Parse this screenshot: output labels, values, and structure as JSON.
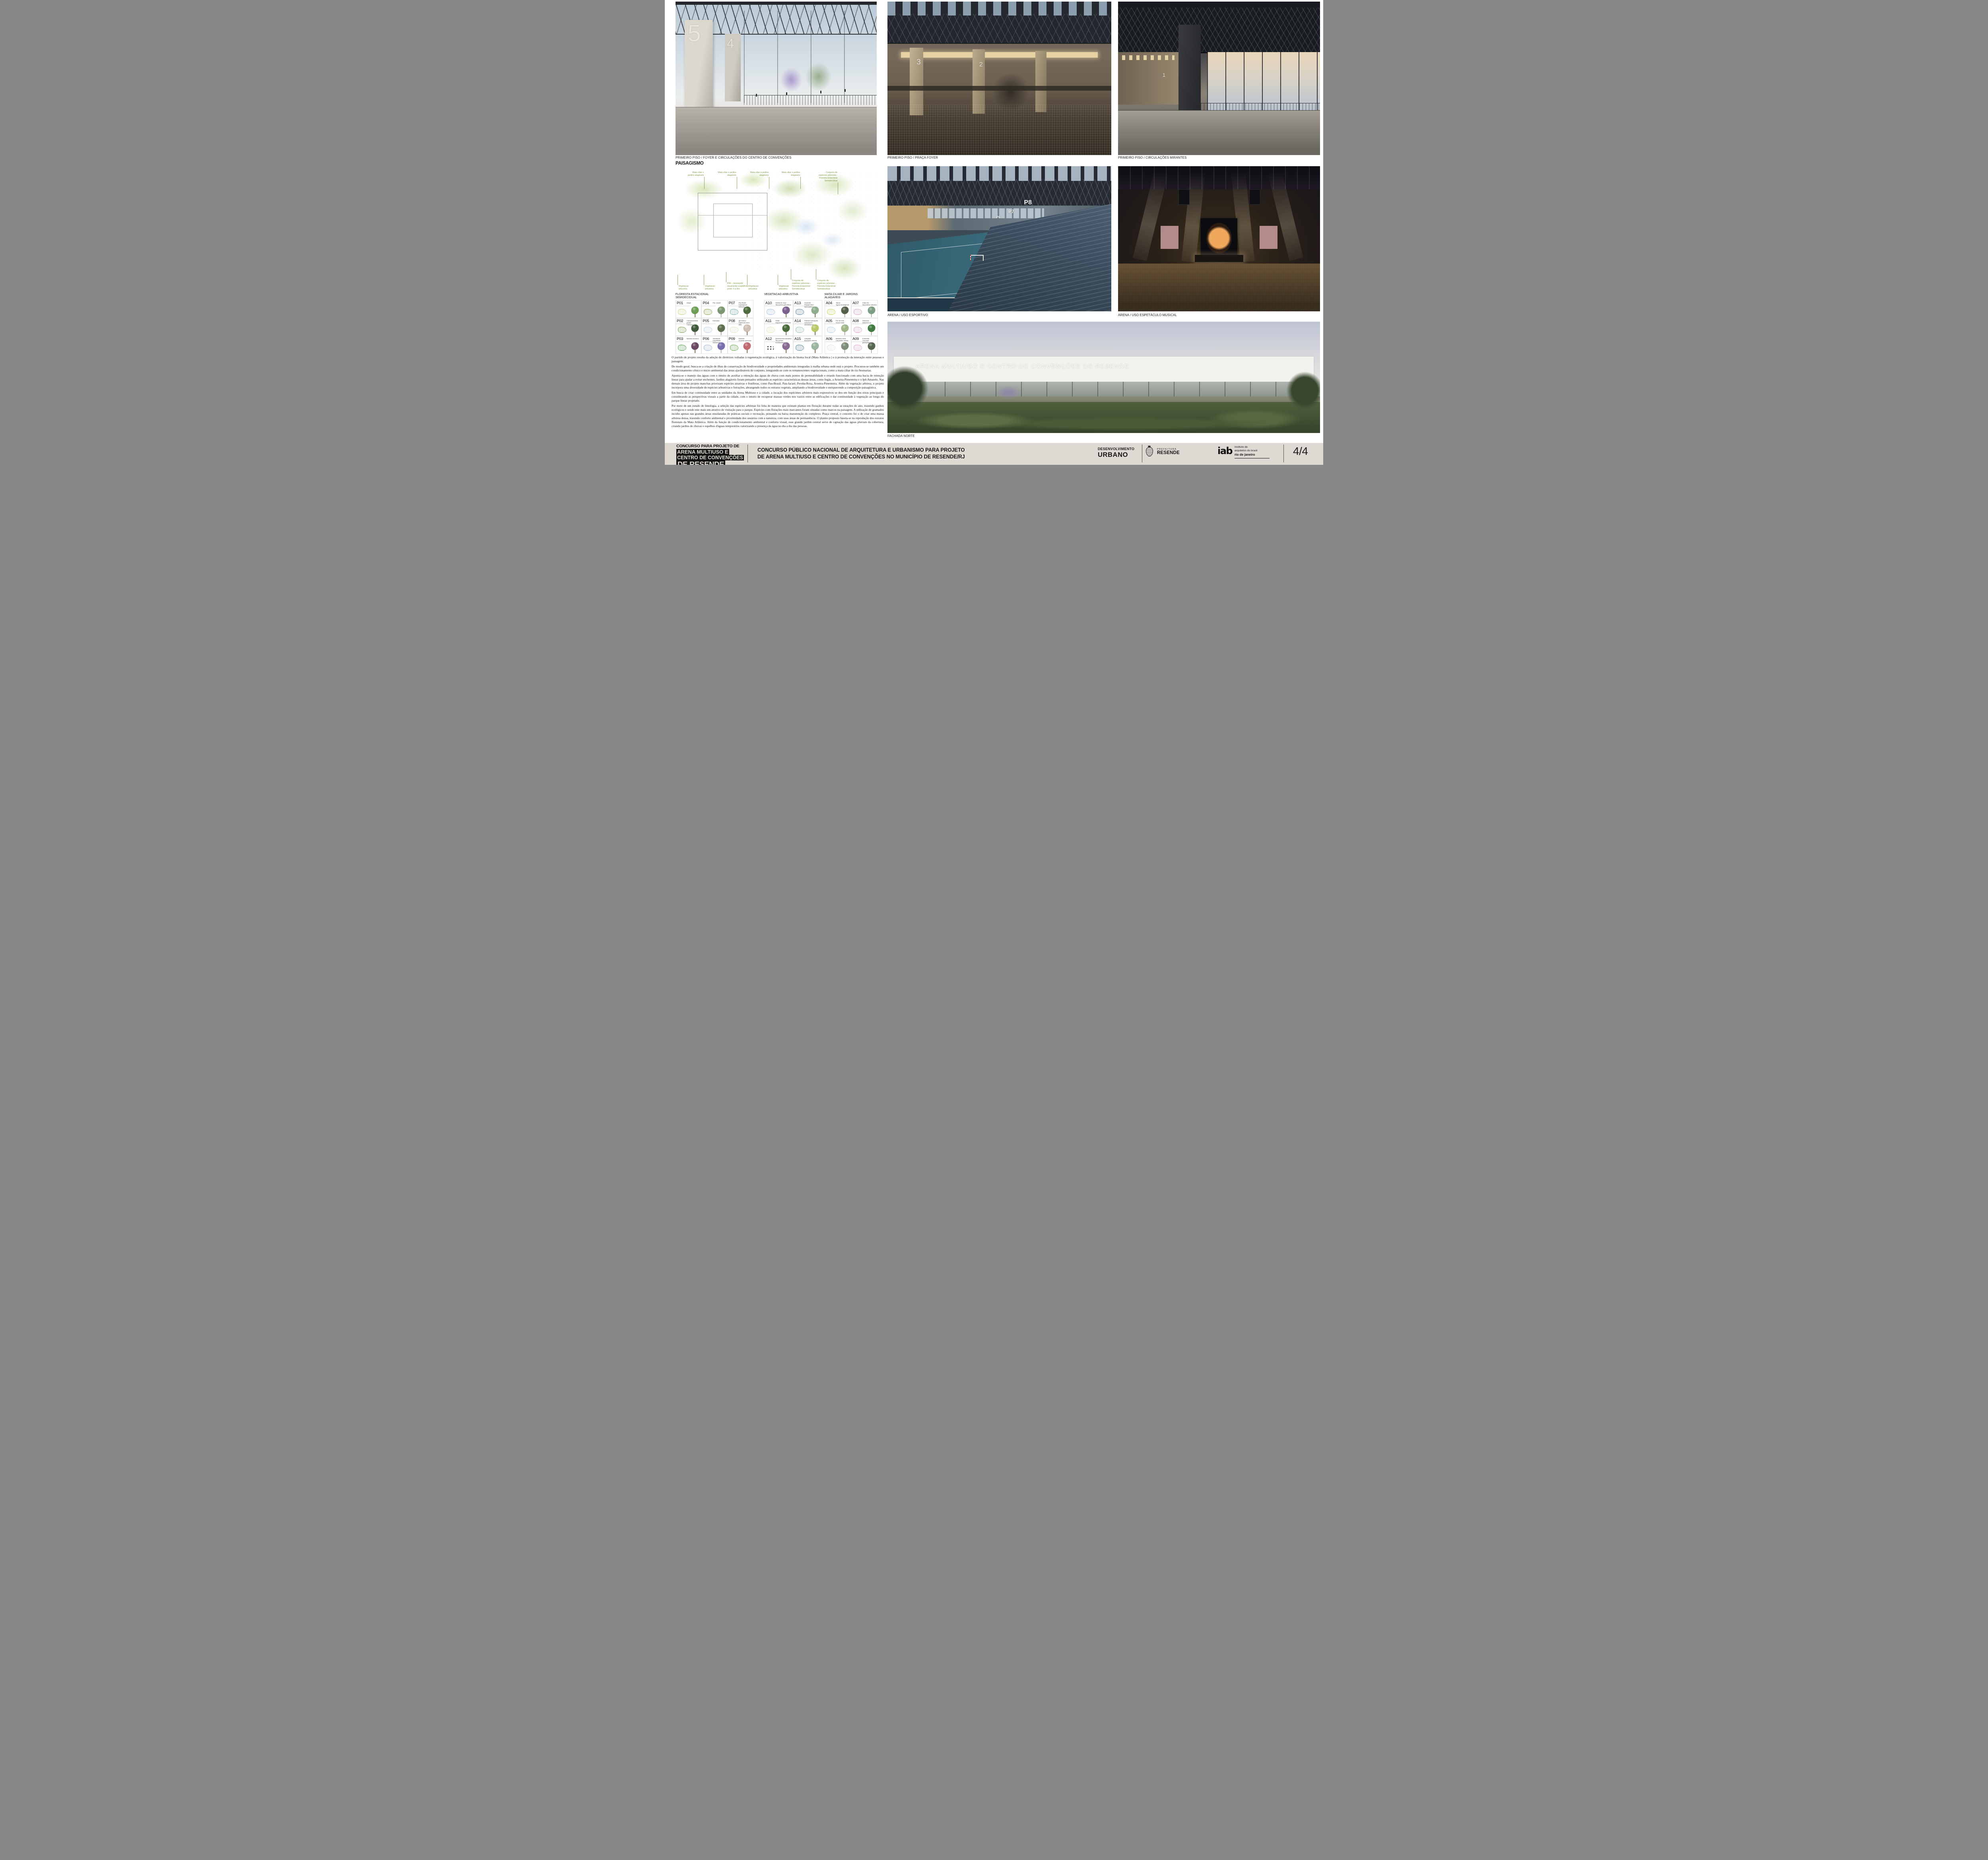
{
  "board": {
    "section_heading": "PAISAGISMO"
  },
  "colors": {
    "page_bg": "#ffffff",
    "footer_bg": "#dedad3",
    "plan_label_green": "#7c9a45",
    "footer_ink": "#131313"
  },
  "captions": {
    "render1": "PRIMEIRO PISO / FOYER E CIRCULAÇÕES DO CENTRO DE CONVENÇÕES",
    "render2": "PRIMEIRO PISO / PRAÇA FOYER",
    "render3": "PRIMEIRO PISO / CIRCULAÇÕES MIRANTES",
    "render4": "ARENA / USO ESPORTIVO",
    "render5": "ARENA / USO ESPETÁCULO MUSICAL",
    "render6": "FACHADA NORTE"
  },
  "render_overlays": {
    "render1_numbers": [
      "5",
      "4"
    ],
    "render2_numbers": [
      "3",
      "2"
    ],
    "render3_numbers": [
      "1"
    ],
    "arena_signs": [
      "P8",
      "P7",
      "P6"
    ],
    "fachada_building_title": "ARENA MULTIUSO E CENTRO DE CONVENÇÕES DE RESENDE"
  },
  "plan": {
    "labels_top": [
      "Mata ciliar e\njardins alagáveis",
      "Mata ciliar e jardins\nalagáveis",
      "Mata ciliar e jardins\nalagáveis",
      "Mata ciliar e jardins\nalagáveis",
      "Conjunto de\nespécies arboreas -\nFloresta Estacional\nSemidecidual"
    ],
    "labels_bottom": [
      "Vegetacao\narbustiva",
      "Vegetacao\narbustiva",
      "P06 - Jacarandá\nJacaranda cuspidifolia\nporte: 5 a 8m",
      "Vegetacao\narbustiva",
      "Vegetacao\narbustiva",
      "Conjunto de\nespécies arboreas -\nFloresta Estacional\nSemidecidual",
      "Conjunto de\nespécies arboreas -\nFloresta Estacional\nSemidecidual"
    ]
  },
  "legend": {
    "groups": [
      {
        "title": "FLORESTA ESTACIONAL\nSEMIDECIDUAL",
        "items": [
          {
            "code": "P01",
            "name": "Araçá",
            "swatch": "#c9da8a",
            "photo": "#6f9e56"
          },
          {
            "code": "P02",
            "name": "Campomanesia phaea\nCambuci",
            "swatch": "#7aa84e",
            "photo": "#3f5a3a"
          },
          {
            "code": "P03",
            "name": "Manacá da serra",
            "swatch": "#57a84e",
            "photo": "#6b4a63"
          },
          {
            "code": "P04",
            "name": "Pau Jacaré",
            "swatch": "#8fae56",
            "photo": "#7d9770"
          },
          {
            "code": "P05",
            "name": "Embauba",
            "swatch": "#bcd3ea",
            "photo": "#5e7050"
          },
          {
            "code": "P06",
            "name": "Jacaranda cuspidifolia\nJacarandá",
            "swatch": "#9db8d8",
            "photo": "#7a6fae"
          },
          {
            "code": "P07",
            "name": "Pau Brasil\nCaesalpinia echinata",
            "swatch": "#7fb2b2",
            "photo": "#4e6b3c"
          },
          {
            "code": "P08",
            "name": "Ipê branco\nTabebuia roseo-alba",
            "swatch": "#d8e6c2",
            "photo": "#cfc0b4"
          },
          {
            "code": "P09",
            "name": "Paineira\nChorisia speciosa",
            "swatch": "#6cae52",
            "photo": "#c06a72"
          }
        ]
      },
      {
        "title": "VEGETACAO ARBUSTIVA",
        "items": [
          {
            "code": "A10",
            "name": "Orelha de onça\nTibouchina grandiflora",
            "swatch": "#a9c4e0",
            "photo": "#7b5f8f"
          },
          {
            "code": "A11",
            "name": "Triális\nGalphimia brasiliensis",
            "swatch": "#dfe8bb",
            "photo": "#4a6b3a"
          },
          {
            "code": "A12",
            "name": "Quaresmeira arbustiva\nTibouchina moricandiana",
            "swatch": "#333333",
            "photo": "#8a6b93"
          },
          {
            "code": "A13",
            "name": "Guaimbé\nPhilodendron bipinnatifidum",
            "swatch": "#6f8fa5",
            "photo": "#8fae8f"
          },
          {
            "code": "A14",
            "name": "Palmeira petrópolis\nLytocaryum weddellianum",
            "swatch": "#9fc4bd",
            "photo": "#b9c96a"
          },
          {
            "code": "A15",
            "name": "Carqueja\nBaccharis trimera",
            "swatch": "#5f8fa0",
            "photo": "#9ab5a0"
          }
        ]
      },
      {
        "title": "MATA CILIAR E JARDINS\nALAGAVEIS",
        "items": [
          {
            "code": "A04",
            "name": "Taboa\nTypha domingensii",
            "swatch": "#cada6a",
            "photo": "#55604a"
          },
          {
            "code": "A05",
            "name": "Flor de vela\nSenna alata",
            "swatch": "#b9d0e6",
            "photo": "#9fb789"
          },
          {
            "code": "A06",
            "name": "Maranta cinza\nCtenanthe setosa",
            "swatch": "#dfe8e2",
            "photo": "#7f8f77"
          },
          {
            "code": "A07",
            "name": "Falsa íris\nNeomarica caerulea",
            "swatch": "#d8a9c9",
            "photo": "#7d9f86"
          },
          {
            "code": "A08",
            "name": "Heliconia\nHeliconia sp",
            "swatch": "#e0a9cf",
            "photo": "#3f7a3f"
          },
          {
            "code": "A09",
            "name": "Embauba\nCecropia pachystachya",
            "swatch": "#e3a9d0",
            "photo": "#55684f"
          }
        ]
      }
    ]
  },
  "text_block": {
    "paragraphs": [
      "O partido de projeto resulta da adoção de diretrizes voltadas à regeneração ecológica, à valorização do bioma local (Mata Atlântica ) e à promoção da interação entre pessoas e paisagem.",
      "De modo geral, busca-se a criação de ilhas de conservação de biodiversidade e propriedades ambientais integradas à malha urbana onde está o projeto. Procurou-se também um condicionamento cênico e micro ambiental das áreas ajardináveis do conjunto, integrando-se com os remanescentes vegetacionais, como a mata ciliar do rio Sesmarias.",
      "Aponta-se o manejo das águas com o intuito de auxiliar a retenção das águas de chuva com mais pontos de permeabilidade e retardo funcionado com uma bacia de retenção linear para ajudar a evitar enchentes. Jardins alagáveis foram pensados utilizando as espécies características dessas áreas, como Ingás, a Aroeira-Pimenteira e o Ipê-Amarelo. Nas demais área do projeto manchas priorizam espécies atrativas e frutíferas, como Pau-Brasil, Pau-Jacaré, Peroba-Rosa, Aroeira-Pimenteira. Além da vegetação arbórea, o projeto incorpora uma diversidade de espécies arbustivas e forrações, abrangendo todos os estratos vegetais, ampliando a biodiversidade e enriquecendo a composição paisagística.",
      "Em busca de criar continuidade entre as unidades da Arena Multiuso e a cidade, a locação dos espécimes arbóreos mais expressivos se deu em função dos eixos principais e considerando as perspectivas visuais a partir da cidade, com o intuito de recuperar massas verdes nos vazios entre as edificações e dar continuidade à vegetação ao longo do parque linear projetado.",
      "Por meio de um estudo de fenologia, a seleção das espécies arbóreas foi feita de maneira que existam plantas em floração durante todas as estações do ano, trazendo ganhos ecológicos e sendo este mais um atrativo de visitação para o parque. Espécies com florações mais marcantes foram situadas como marcos na paisagem. A utilização de gramados incidiu apenas nas grandes áreas ensolaradas de práticas sociais e recreação, pensando na baixa manutenção do complexo. Praça central, o conceito foi o de criar uma massa arbórea densa, trazendo conforto ambiental e proximidade dos usuários com a natureza, com suas áreas de permanência. O plantio proposto baseia-se na reprodução dos estratos florestais da Mata Atlântica. Além da função de condicionamento ambiental e conforto visual, esse grande jardim central serve de captação das águas pluviais da cobertura, criando jardins de chuvas e espelhos d'águas temporários valorizando a presença da água no dia a dia das pessoas."
    ]
  },
  "footer": {
    "box_line1": "CONCURSO PARA PROJETO DE",
    "box_line2": "ARENA MULTIUSO E",
    "box_line3": "CENTRO DE CONVENÇÕES",
    "box_line4": "DE RESENDE",
    "title_line1": "CONCURSO PÚBLICO NACIONAL DE ARQUITETURA E URBANISMO PARA PROJETO",
    "title_line2": "DE ARENA MULTIUSO E CENTRO DE CONVENÇÕES NO MUNICÍPIO DE RESENDE/RJ",
    "logo_desenvolvimento_line1": "DESENVOLVIMENTO",
    "logo_desenvolvimento_line2": "URBANO",
    "logo_prefeitura_line1": "PREFEITURA",
    "logo_prefeitura_line2": "RESENDE",
    "iab_mark": "iab",
    "logo_iab_line1": "instituto de",
    "logo_iab_line2": "arquitetos do brasil",
    "logo_iab_line3": "rio de janeiro",
    "page_number": "4/4"
  }
}
